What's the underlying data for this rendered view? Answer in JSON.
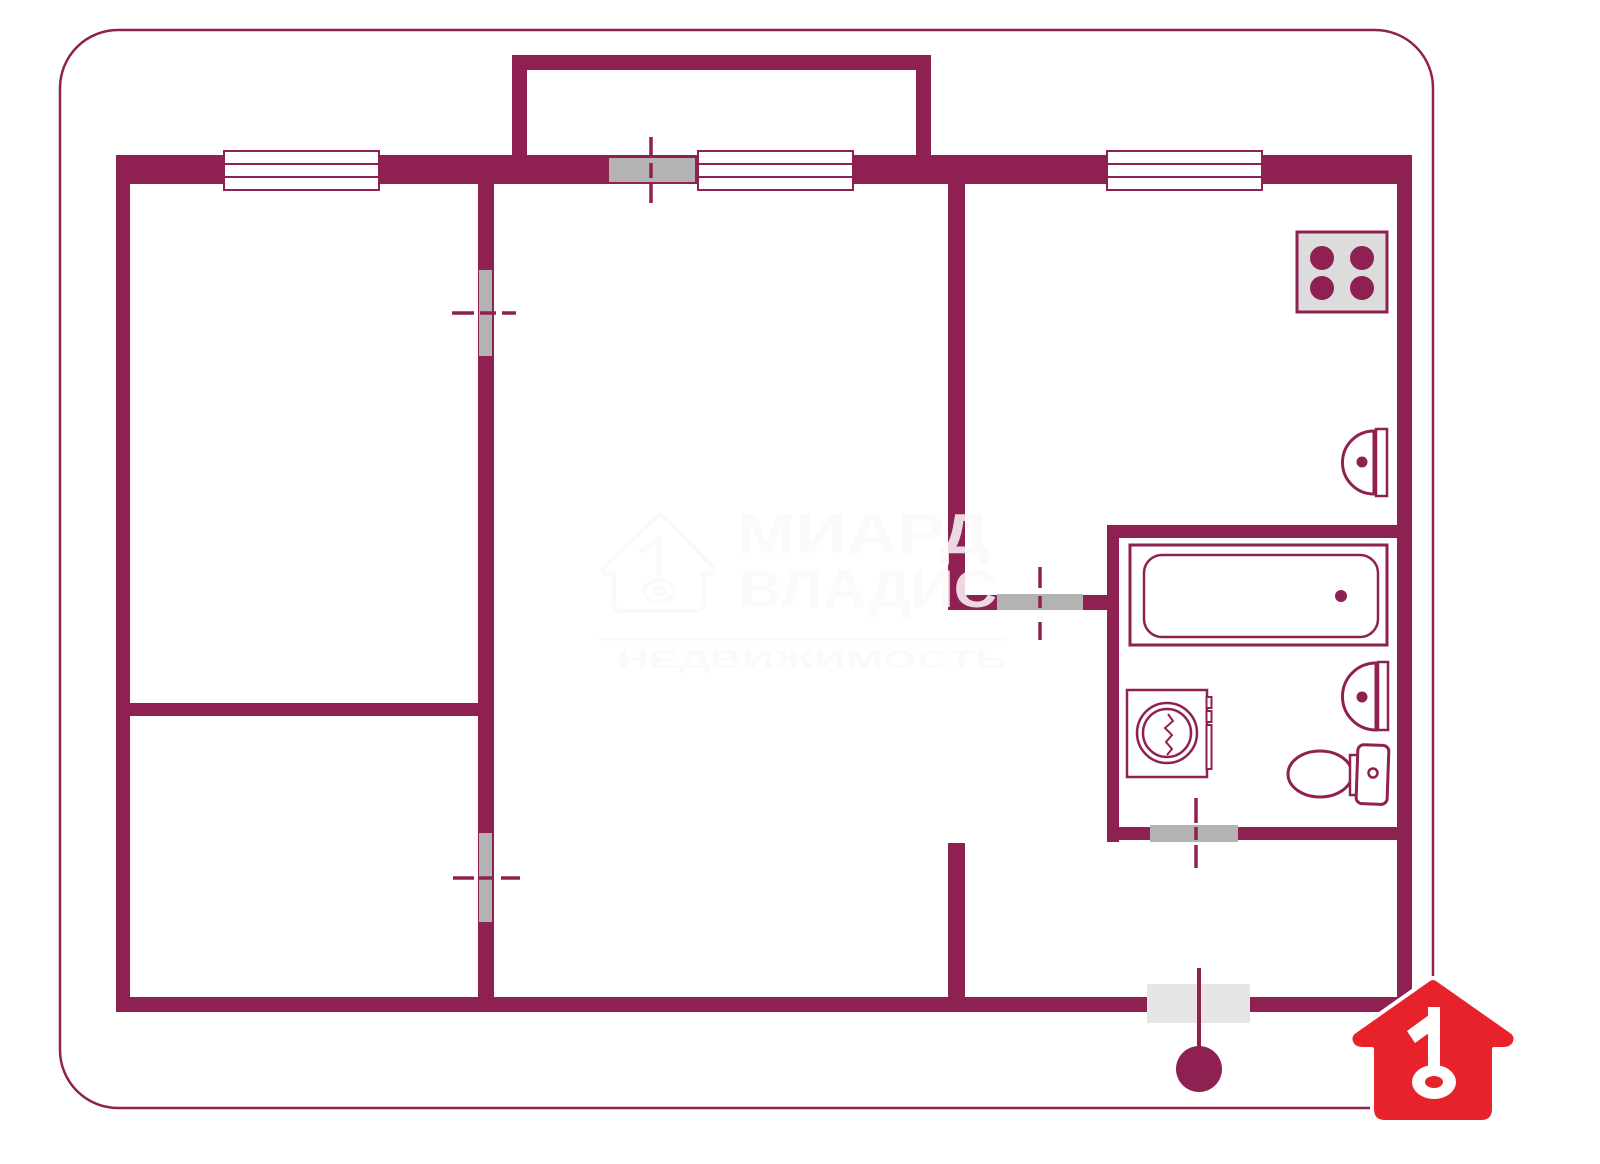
{
  "title": "apartment-floor-plan",
  "colors": {
    "background": "#ffffff",
    "wall": "#8e2152",
    "door_leaf": "#b3b3b3",
    "entrance_door_leaf": "#e6e6e6",
    "stove_top": "#dcdcdc",
    "fixture_fill": "#ffffff",
    "logo_red": "#e8222a",
    "logo_key_white": "#ffffff",
    "watermark_tint": "rgba(252,248,249,0.85)"
  },
  "watermark": {
    "line1": "МИАРД",
    "line2": "ВЛАДИС",
    "line3": "НЕДВИЖИМОСТЬ",
    "icon": "house-with-key-1-outline"
  },
  "plan": {
    "rooms": [
      "room-top-left",
      "room-bottom-left",
      "room-central",
      "kitchen",
      "bathroom",
      "hallway",
      "balcony"
    ],
    "windows": [
      "window-room-top-left",
      "window-balcony-room",
      "window-kitchen"
    ],
    "doors": [
      "balcony-door",
      "room-top-left-door",
      "room-bottom-left-door",
      "kitchen-hall-door",
      "bathroom-door",
      "entrance-door"
    ],
    "fixtures": [
      "stove-4-burner",
      "kitchen-sink",
      "bathtub",
      "washing-machine",
      "bathroom-sink",
      "toilet"
    ],
    "entrance_marker": "circle-with-stem"
  },
  "logo": {
    "name": "red-house-number-1-key-logo"
  }
}
